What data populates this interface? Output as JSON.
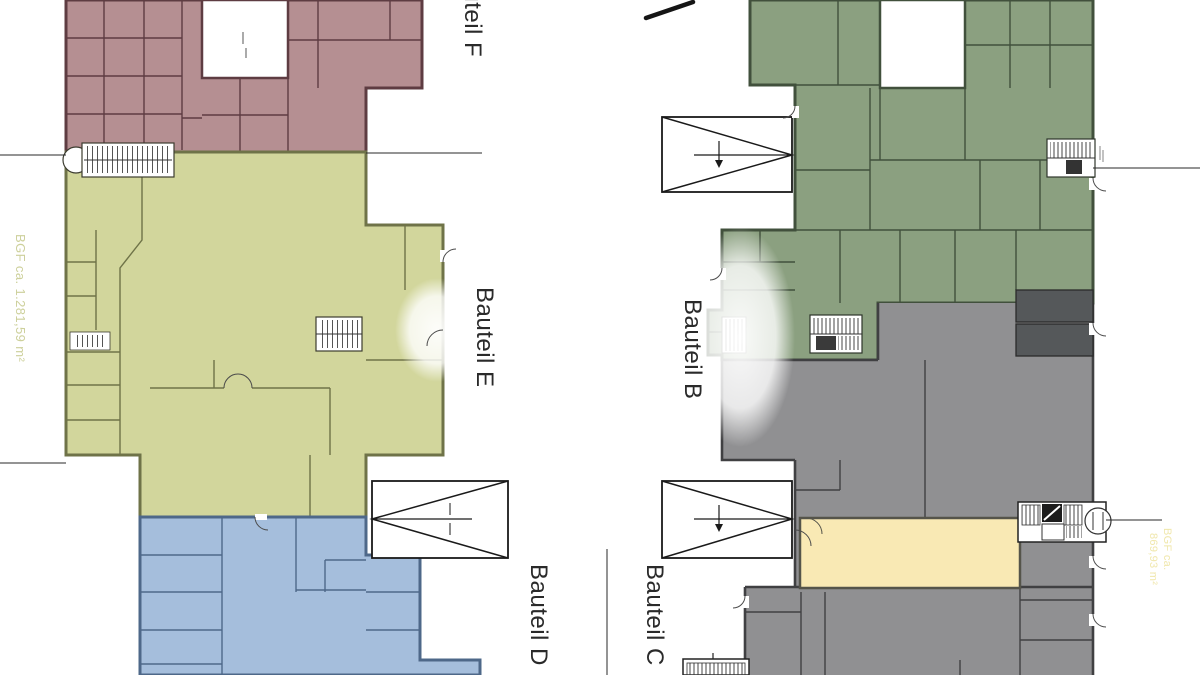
{
  "plan": {
    "building_labels": [
      {
        "id": "f",
        "text": "Bauteil F"
      },
      {
        "id": "e",
        "text": "Bauteil E"
      },
      {
        "id": "b",
        "text": "Bauteil B"
      },
      {
        "id": "d",
        "text": "Bauteil D"
      },
      {
        "id": "c",
        "text": "Bauteil C"
      }
    ],
    "area_labels": {
      "left": "BGF ca. 1.281,59 m²",
      "right_line1": "BGF ca.",
      "right_line2": "869,93 m²"
    }
  },
  "colors": {
    "bauteil_f_fill": "#b58f92",
    "bauteil_f_wall": "#5e3c42",
    "bauteil_e_fill": "#d2d69c",
    "bauteil_e_wall": "#6f7348",
    "bauteil_d_fill": "#a5bedc",
    "bauteil_d_wall": "#4e6889",
    "bauteil_b_fill": "#8ba080",
    "bauteil_b_wall": "#41503c",
    "bauteil_c_fill": "#909092",
    "bauteil_c_wall": "#404042",
    "dark_room_fill": "#55585a",
    "highlight_room_fill": "#f9e9b4",
    "highlight_room_border": "#55544a",
    "area_text_left": "#cdd09b",
    "area_text_right": "#f0e7ac",
    "line": "#2a2a2a"
  }
}
